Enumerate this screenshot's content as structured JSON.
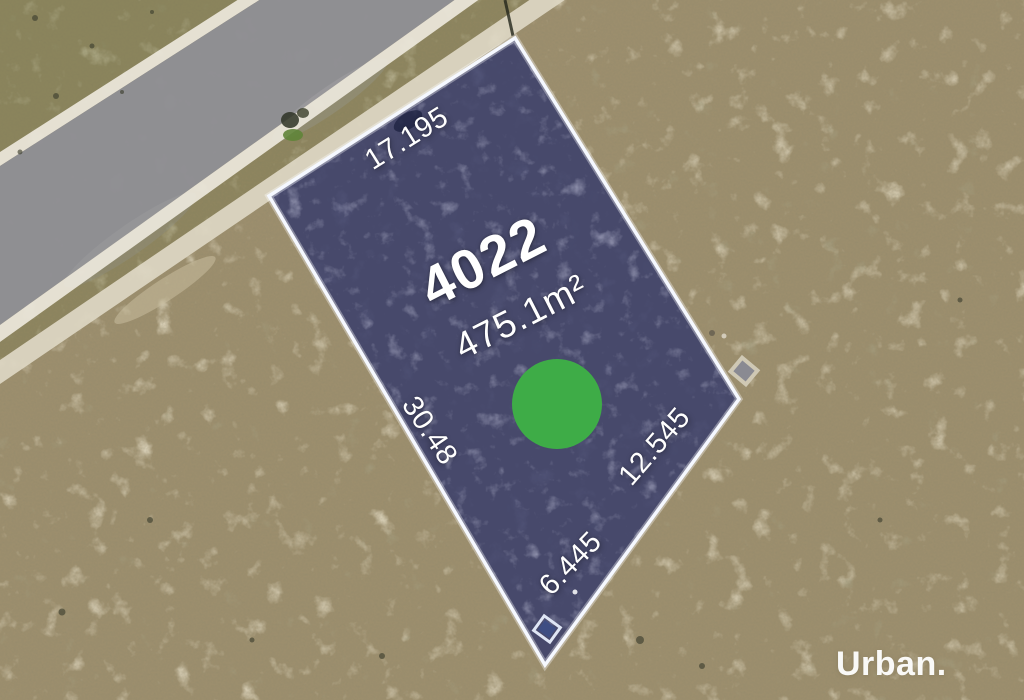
{
  "lot": {
    "number": "4022",
    "area": "475.1m²",
    "dimensions": {
      "top": "17.195",
      "left": "30.48",
      "bottom": "6.445",
      "right": "12.545"
    }
  },
  "watermark": {
    "text": "Urban."
  },
  "colors": {
    "field": "#9c8e6d",
    "road": "#8f8f93",
    "kerb": "#e9e5d8",
    "footpath": "#ddd6c3",
    "lot_overlay": "#383d6b",
    "lot_border": "#f5f8ff",
    "marker_green": "#3eac47"
  }
}
